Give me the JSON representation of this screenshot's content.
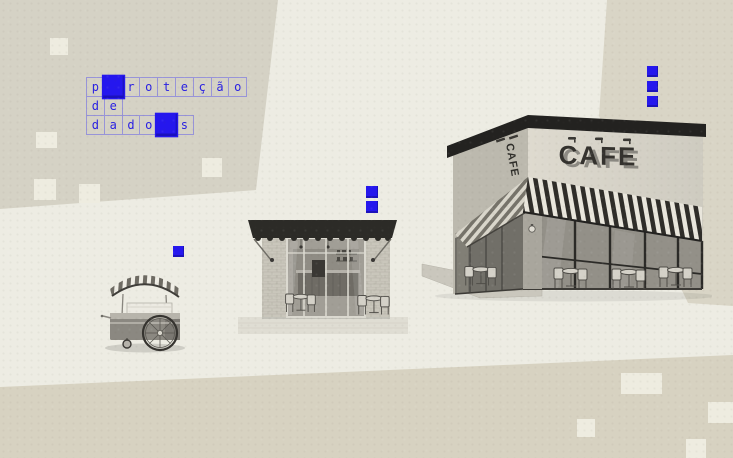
{
  "crossword": {
    "word_full": "proteção de dados",
    "rows": [
      {
        "cells": [
          "p",
          "",
          "r",
          "o",
          "t",
          "e",
          "ç",
          "ã",
          "o"
        ],
        "filled_index": 1
      },
      {
        "cells": [
          "d",
          "e"
        ],
        "filled_index": null
      },
      {
        "cells": [
          "d",
          "a",
          "d",
          "o",
          "",
          "s"
        ],
        "filled_index": 4
      }
    ]
  },
  "buildings": {
    "large_cafe": {
      "sign_front": "CAFE",
      "sign_side": "CAFE"
    },
    "small_cafe": {
      "sign_front": ""
    },
    "cart": {
      "sign": ""
    }
  },
  "decor": {
    "blue_pixel_squares": {
      "above_cart": 1,
      "above_small_cafe": 2,
      "above_large_cafe": 3
    },
    "light_squares_count": 9
  },
  "colors": {
    "accent_blue": "#2517ee",
    "crossword_letter_blue": "#2a21e2",
    "crossword_border": "#9894d8",
    "background_light": "#edece3",
    "background_dark_panel": "#d6d2c3",
    "decor_square_light": "#eeece0",
    "illustration_style": "grayscale 3d render"
  }
}
